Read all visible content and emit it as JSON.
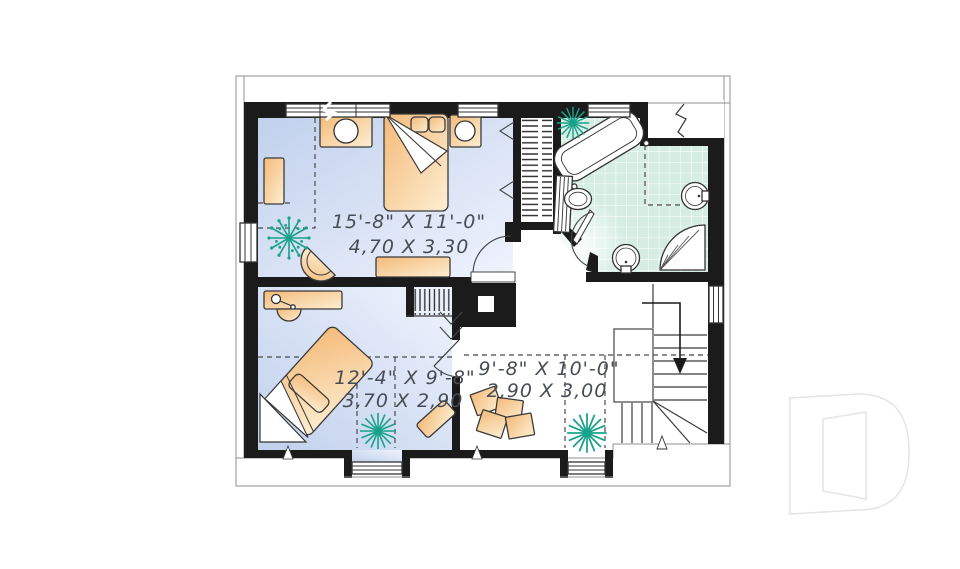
{
  "page": {
    "background": "#ffffff"
  },
  "watermark": {
    "letter": "D"
  },
  "plan": {
    "type": "floor-plan",
    "rooms": [
      {
        "id": "bedroom-1",
        "imperial": "15'-8\" X 11'-0\"",
        "metric": "4,70 X 3,30"
      },
      {
        "id": "bedroom-2",
        "imperial": "12'-4\" X 9'-8\"",
        "metric": "3,70 X 2,90"
      },
      {
        "id": "hall",
        "imperial": "9'-8\" X 10'-0\"",
        "metric": "2,90 X 3,00"
      }
    ],
    "colors": {
      "wall": "#1b1b1b",
      "bedroom_floor_dark": "#c0d0ec",
      "bedroom_floor_light": "#eff3fd",
      "bathroom_tile": "#d6ede4",
      "furniture_dark": "#f4ba79",
      "furniture_light": "#fdeed2",
      "plant": "#18a28c",
      "dimension_text": "#484d55",
      "watermark_stroke": "#e4e4e4"
    },
    "icons": [
      "bed-icon",
      "nightstand-icon",
      "lamp-icon",
      "dresser-icon",
      "chair-icon",
      "desk-icon",
      "bathtub-icon",
      "toilet-icon",
      "sink-icon",
      "corner-shower-icon",
      "linen-slats-icon",
      "closet-hangers-icon",
      "plant-icon",
      "stairs-icon",
      "down-arrow-icon",
      "door-swing-icon",
      "window-icon",
      "chimney-icon",
      "papers-icon",
      "rug-icon"
    ]
  }
}
